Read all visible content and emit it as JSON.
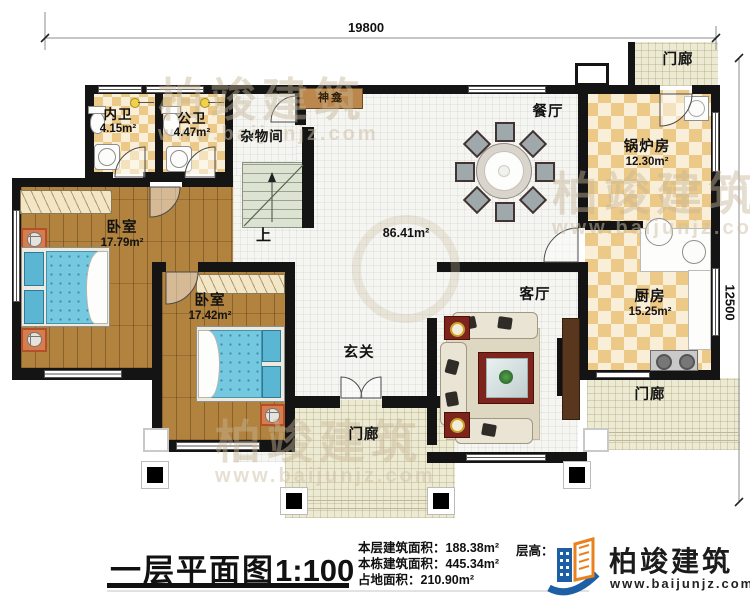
{
  "dimensions": {
    "top": "19800",
    "right": "12500"
  },
  "rooms": {
    "neiwei": {
      "label": "内卫",
      "area": "4.15m²"
    },
    "gongwei": {
      "label": "公卫",
      "area": "4.47m²"
    },
    "zawujian": {
      "label": "杂物间"
    },
    "shenkan": {
      "label": "神龛"
    },
    "canting": {
      "label": "餐厅"
    },
    "guolufang": {
      "label": "锅炉房",
      "area": "12.30m²"
    },
    "chufang": {
      "label": "厨房",
      "area": "15.25m²"
    },
    "woshi1": {
      "label": "卧室",
      "area": "17.79m²"
    },
    "woshi2": {
      "label": "卧室",
      "area": "17.42m²"
    },
    "stairs_up": {
      "label": "上"
    },
    "hall": {
      "label": "86.41m²"
    },
    "xuanguan": {
      "label": "玄关"
    },
    "keting": {
      "label": "客厅"
    },
    "menlang_top_right": {
      "label": "门廊"
    },
    "menlang_bottom_center": {
      "label": "门廊"
    },
    "menlang_bottom_right": {
      "label": "门廊"
    }
  },
  "title": {
    "text": "一层平面图",
    "scale": "1:100"
  },
  "stats": {
    "line1_label": "本层建筑面积：",
    "line1_value": "188.38m²",
    "line2_label": "本栋建筑面积：",
    "line2_value": "445.34m²",
    "line3_label": "占地面积：",
    "line3_value": "210.90m²",
    "floor_height_label": "层高："
  },
  "logo": {
    "name": "柏竣建筑",
    "url": "www.baijunjz.com"
  },
  "watermark": {
    "name": "柏竣建筑",
    "url": "www.baijunjz.com"
  },
  "colors": {
    "wall": "#141414",
    "checker_tan": "#ecc987",
    "wood": "#b2823f",
    "bed_blue": "#74c9e0",
    "logo_blue": "#1c5fa5",
    "logo_orange": "#e8821e"
  }
}
